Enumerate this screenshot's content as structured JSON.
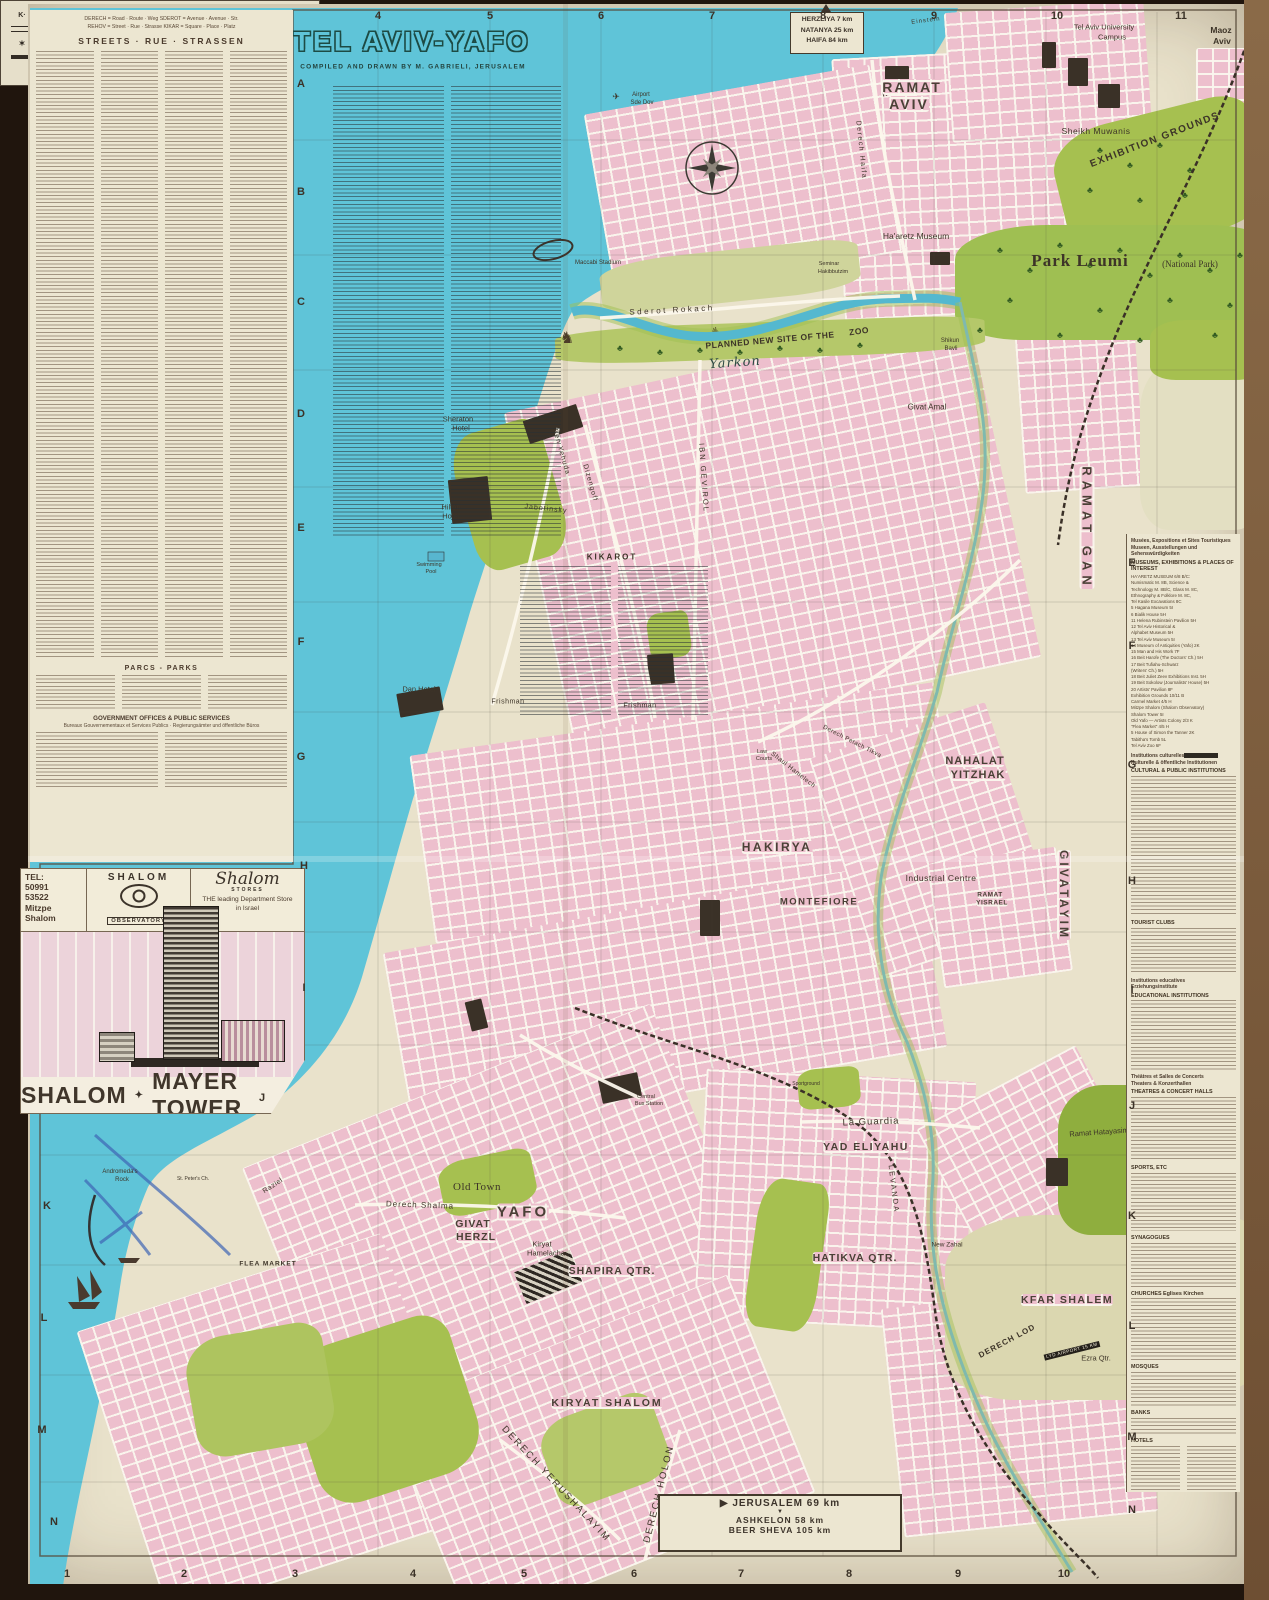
{
  "colors": {
    "sea": "#5fc4d8",
    "built_up": "#edbfcd",
    "park_green": "#a6c050",
    "paper": "#e9e2cb",
    "ink": "#3d3428"
  },
  "title": {
    "main": "TEL AVIV-YAFO",
    "credit": "COMPILED AND DRAWN BY M. GABRIELI, JERUSALEM"
  },
  "signs": {
    "north": {
      "arrow": "▲",
      "lines": [
        "HERZLIYA 7 km",
        "NATANYA 25 km",
        "HAIFA 84 km"
      ]
    },
    "south": {
      "arrow_right": "▶",
      "arrow_down": "▼",
      "lines": [
        "JERUSALEM 69 km",
        "ASHKELON 58 km",
        "BEER SHEVA 105 km"
      ]
    }
  },
  "index_panel": {
    "key_line1": "DERECH = Road · Route · Weg        SDEROT = Avenue · Avenue · Str.",
    "key_line2": "REHOV = Street · Rue · Strasse        KIKAR = Square · Place · Platz",
    "streets_header": "STREETS  ·  RUE  ·  STRASSEN",
    "parks_header": "PARCS  -  PARKS",
    "gov_header": "GOVERNMENT OFFICES & PUBLIC SERVICES",
    "gov_sub": "Bureaux Gouvernementaux et Services Publics  ·  Regierungsämter und öffentliche Büros",
    "kikarot_header": "KIKAROT"
  },
  "shalom_inset": {
    "tel_lines": [
      "TEL:",
      "50991",
      "53522",
      "Mitzpe",
      "Shalom"
    ],
    "brand": "SHALOM",
    "observatory": "OBSERVATORY",
    "stores_script": "Shalom",
    "stores_word": "STORES",
    "slogan_line1": "THE leading Department Store",
    "slogan_line2": "in Israel",
    "banner_left": "SHALOM",
    "banner_right": "MAYER TOWER"
  },
  "legend": {
    "left": [
      {
        "sym": "kikar",
        "label": "KIKAR 'Sq.' SQUARE"
      },
      {
        "sym": "road2",
        "label": "MAIN INTERURBAN ROAD"
      },
      {
        "sym": "syn",
        "label": "SYNAGOGUE"
      },
      {
        "sym": "road1",
        "label": "MAIN THROUGH ROAD"
      }
    ],
    "right": [
      {
        "sym": "rail",
        "label": "RAILWAY"
      },
      {
        "sym": "park",
        "label": "PARK"
      },
      {
        "sym": "cem",
        "label": "CEMETERY"
      },
      {
        "sym": "dot",
        "label": "HOTEL"
      }
    ],
    "credit": "© MAP BY M. GABRIELI, JERUSALEM"
  },
  "grid": {
    "top": [
      {
        "t": "4",
        "x": 378
      },
      {
        "t": "5",
        "x": 490
      },
      {
        "t": "6",
        "x": 601
      },
      {
        "t": "7",
        "x": 712
      },
      {
        "t": "8",
        "x": 823
      },
      {
        "t": "9",
        "x": 934
      },
      {
        "t": "10",
        "x": 1057
      },
      {
        "t": "11",
        "x": 1181
      }
    ],
    "bottom": [
      {
        "t": "1",
        "x": 67
      },
      {
        "t": "2",
        "x": 184
      },
      {
        "t": "3",
        "x": 295
      },
      {
        "t": "4",
        "x": 413
      },
      {
        "t": "5",
        "x": 524
      },
      {
        "t": "6",
        "x": 634
      },
      {
        "t": "7",
        "x": 741
      },
      {
        "t": "8",
        "x": 849
      },
      {
        "t": "9",
        "x": 958
      },
      {
        "t": "10",
        "x": 1064
      }
    ],
    "left": [
      {
        "t": "A",
        "x": 301,
        "y": 84
      },
      {
        "t": "B",
        "x": 301,
        "y": 192
      },
      {
        "t": "C",
        "x": 301,
        "y": 302
      },
      {
        "t": "D",
        "x": 301,
        "y": 414
      },
      {
        "t": "E",
        "x": 301,
        "y": 528
      },
      {
        "t": "F",
        "x": 301,
        "y": 642
      },
      {
        "t": "G",
        "x": 301,
        "y": 757
      },
      {
        "t": "H",
        "x": 304,
        "y": 866
      },
      {
        "t": "I",
        "x": 304,
        "y": 988
      },
      {
        "t": "J",
        "x": 262,
        "y": 1098
      },
      {
        "t": "K",
        "x": 47,
        "y": 1206
      },
      {
        "t": "L",
        "x": 44,
        "y": 1318
      },
      {
        "t": "M",
        "x": 42,
        "y": 1430
      },
      {
        "t": "N",
        "x": 54,
        "y": 1522
      }
    ],
    "right": [
      {
        "t": "E",
        "x": 1132,
        "y": 563
      },
      {
        "t": "F",
        "x": 1132,
        "y": 646
      },
      {
        "t": "G",
        "x": 1132,
        "y": 765
      },
      {
        "t": "H",
        "x": 1132,
        "y": 881
      },
      {
        "t": "I",
        "x": 1132,
        "y": 990
      },
      {
        "t": "J",
        "x": 1132,
        "y": 1106
      },
      {
        "t": "K",
        "x": 1132,
        "y": 1216
      },
      {
        "t": "L",
        "x": 1132,
        "y": 1326
      },
      {
        "t": "M",
        "x": 1132,
        "y": 1437
      },
      {
        "t": "N",
        "x": 1132,
        "y": 1510
      }
    ]
  },
  "sidebar": {
    "sections": [
      {
        "fr": "Musées, Expositions et Sites Touristiques",
        "de": "Museen, Ausstellungen und Sehenswürdigkeiten",
        "en": "MUSEUMS, EXHIBITIONS & PLACES OF INTEREST",
        "entries": [
          "HA'ARETZ MUSEUM 6/8 B/C:",
          "Numismatic M. 8B, Science &",
          "Technology M. 8B/C, Glass M. 8C,",
          "Ethnography & Folklore M. 8C,",
          "Tel Kasile Excavations 8C",
          "5 Hagana Museum 5I",
          "6 Bialik House 5H",
          "11 Helena Rubinstein Pavilion 5H",
          "12 Tel Aviv Historical &",
          "    Alphabet Museum 5H",
          "13 Tel Aviv Museum 5I",
          "14 Museum of Antiquities (Yafo) 2K",
          "15 Man and His Work 7F",
          "16 Beit Harofe (The Doctors' Ch.) 5H",
          "17 Beit Tufiahu-Schwarz",
          "    (Writers' Ch.) 5H",
          "18 Beit Juliet Zeev Exhibitions Inst. 5H",
          "19 Beit Sokolow (Journalists' House) 5H",
          "20 Artists' Pavilion 8F",
          "Exhibition Grounds 10/11 B",
          "Carmel Market 4/5 H",
          "Mitzpe Shalom (Shalom Observatory)",
          "Shalom Tower 5I",
          "Old Yafo — Artists Colony 2/3 K",
          "\"Flea Market\" 4/5 H",
          "5 House of Simon the Tanner 2K",
          "Tabitha's Tomb 5L",
          "Tel Aviv Zoo 6F"
        ],
        "fuzz": 0
      },
      {
        "fr": "Institutions culturelles",
        "de": "Kulturelle & öffentliche Institutionen",
        "en": "CULTURAL & PUBLIC INSTITUTIONS",
        "fuzz": 140,
        "hl": true
      },
      {
        "en": "TOURIST CLUBS",
        "fuzz": 46
      },
      {
        "fr": "Institutions educatives",
        "de": "Erziehungsinstitute",
        "en": "EDUCATIONAL INSTITUTIONS",
        "fuzz": 70
      },
      {
        "fr": "Théâtres et Salles de Concerts",
        "de": "Theaters & Konzerthallen",
        "en": "THEATRES & CONCERT HALLS",
        "fuzz": 64
      },
      {
        "en": "SPORTS, ETC",
        "fuzz": 58
      },
      {
        "en": "SYNAGOGUES",
        "fuzz": 44
      },
      {
        "en": "CHURCHES  Eglises  Kirchen",
        "fuzz": 62
      },
      {
        "en": "MOSQUES",
        "fuzz": 34
      },
      {
        "en": "BANKS",
        "fuzz": 16
      },
      {
        "en": "HOTELS",
        "fuzz": 70,
        "cols": 2
      }
    ]
  },
  "map_labels": [
    {
      "t": "TEL AVIV-YAFO",
      "x": 412,
      "y": 42,
      "fs": 27,
      "ls": 3,
      "cls": "title"
    },
    {
      "t": "COMPILED AND DRAWN BY M. GABRIELI, JERUSALEM",
      "x": 413,
      "y": 67,
      "fs": 6.5,
      "ls": 1.2,
      "cls": "credit"
    },
    {
      "t": "✈",
      "x": 616,
      "y": 97,
      "fs": 9,
      "cls": "dark"
    },
    {
      "t": "Airport",
      "x": 641,
      "y": 95,
      "fs": 6,
      "cls": "dark"
    },
    {
      "t": "Sde Dov",
      "x": 642,
      "y": 103,
      "fs": 6,
      "cls": "dark"
    },
    {
      "t": "READING",
      "x": 904,
      "y": 90,
      "fs": 6.5,
      "rot": -14,
      "ls": 2,
      "cls": "darkb"
    },
    {
      "t": "Tel Aviv University",
      "x": 1104,
      "y": 27,
      "fs": 7.5,
      "cls": "dark"
    },
    {
      "t": "Campus",
      "x": 1112,
      "y": 37,
      "fs": 7.5,
      "cls": "dark"
    },
    {
      "t": "Maoz",
      "x": 1221,
      "y": 30,
      "fs": 8.5,
      "cls": "darkb"
    },
    {
      "t": "Aviv",
      "x": 1222,
      "y": 41,
      "fs": 8.5,
      "cls": "darkb"
    },
    {
      "t": "Sheikh Muwanis",
      "x": 1096,
      "y": 131,
      "fs": 8.5,
      "ls": 0.5,
      "cls": "dark"
    },
    {
      "t": "RAMAT",
      "x": 912,
      "y": 87,
      "fs": 14,
      "ls": 2,
      "cls": "district"
    },
    {
      "t": "AVIV",
      "x": 909,
      "y": 104,
      "fs": 14,
      "ls": 2,
      "cls": "district"
    },
    {
      "t": "EXHIBITION GROUNDS",
      "x": 1155,
      "y": 140,
      "fs": 10,
      "rot": -21,
      "ls": 1.5,
      "cls": "darkb"
    },
    {
      "t": "Ha'aretz Museum",
      "x": 916,
      "y": 236,
      "fs": 8.5,
      "cls": "dark"
    },
    {
      "t": "Seminar",
      "x": 829,
      "y": 264,
      "fs": 5.5,
      "cls": "dark"
    },
    {
      "t": "Hakibbutzim",
      "x": 833,
      "y": 272,
      "fs": 5.5,
      "cls": "dark"
    },
    {
      "t": "Maccabi Stadium",
      "x": 598,
      "y": 263,
      "fs": 6,
      "cls": "dark"
    },
    {
      "t": "Park Leumi",
      "x": 1080,
      "y": 261,
      "fs": 17,
      "ls": 1,
      "cls": "serifb"
    },
    {
      "t": "(National Park)",
      "x": 1190,
      "y": 264,
      "fs": 9,
      "cls": "serif"
    },
    {
      "t": "Sderot Rokach",
      "x": 672,
      "y": 310,
      "fs": 8,
      "rot": -3,
      "ls": 2.5,
      "cls": "dark"
    },
    {
      "t": "PLANNED NEW SITE OF THE",
      "x": 770,
      "y": 340,
      "fs": 8.5,
      "rot": -5,
      "ls": 0.5,
      "cls": "darkb"
    },
    {
      "t": "ZOO",
      "x": 859,
      "y": 331,
      "fs": 8.5,
      "rot": -8,
      "ls": 0.5,
      "cls": "darkb"
    },
    {
      "t": "Yarkon",
      "x": 735,
      "y": 363,
      "fs": 13,
      "rot": -4,
      "ls": 1,
      "cls": "script"
    },
    {
      "t": "Shikun",
      "x": 950,
      "y": 341,
      "fs": 6,
      "cls": "dark"
    },
    {
      "t": "Bavli",
      "x": 951,
      "y": 349,
      "fs": 6,
      "cls": "dark"
    },
    {
      "t": "Givat Amal",
      "x": 927,
      "y": 407,
      "fs": 8,
      "cls": "dark"
    },
    {
      "t": "Mediterranean",
      "x": 152,
      "y": 642,
      "fs": 31,
      "rot": -63,
      "ls": 5,
      "cls": "script"
    },
    {
      "t": "Sea",
      "x": 225,
      "y": 462,
      "fs": 31,
      "rot": -55,
      "ls": 5,
      "cls": "script"
    },
    {
      "t": "Sheraton",
      "x": 458,
      "y": 419,
      "fs": 7.5,
      "cls": "dark"
    },
    {
      "t": "Hotel",
      "x": 461,
      "y": 428,
      "fs": 7.5,
      "cls": "dark"
    },
    {
      "t": "Hilton",
      "x": 451,
      "y": 507,
      "fs": 7.5,
      "cls": "dark"
    },
    {
      "t": "Hotel",
      "x": 451,
      "y": 516,
      "fs": 7.5,
      "cls": "dark"
    },
    {
      "t": "Swimming",
      "x": 429,
      "y": 565,
      "fs": 5.5,
      "cls": "dark"
    },
    {
      "t": "Pool",
      "x": 431,
      "y": 572,
      "fs": 5.5,
      "cls": "dark"
    },
    {
      "t": "Dan Hotel",
      "x": 419,
      "y": 689,
      "fs": 7.5,
      "cls": "dark"
    },
    {
      "t": "Ben Yehuda",
      "x": 561,
      "y": 452,
      "fs": 7,
      "rot": 74,
      "ls": 1,
      "cls": "dark"
    },
    {
      "t": "Dizengoff",
      "x": 590,
      "y": 483,
      "fs": 7,
      "rot": 74,
      "ls": 1,
      "cls": "dark"
    },
    {
      "t": "Jabotinsky",
      "x": 546,
      "y": 509,
      "fs": 7,
      "rot": 6,
      "ls": 1,
      "cls": "dark"
    },
    {
      "t": "IBN GEVIROL",
      "x": 704,
      "y": 478,
      "fs": 7.5,
      "rot": 86,
      "ls": 2,
      "cls": "dark"
    },
    {
      "t": "Frishman",
      "x": 508,
      "y": 702,
      "fs": 7,
      "ls": 0.5,
      "cls": "dark"
    },
    {
      "t": "Frishman",
      "x": 640,
      "y": 706,
      "fs": 7,
      "ls": 0.5,
      "cls": "dark"
    },
    {
      "t": "RAMAT GAN",
      "x": 1087,
      "y": 528,
      "fs": 13,
      "rot": 90,
      "ls": 5,
      "cls": "district"
    },
    {
      "t": "Derech Haifa",
      "x": 861,
      "y": 150,
      "fs": 7,
      "rot": 84,
      "ls": 1.5,
      "cls": "dark"
    },
    {
      "t": "Einstein",
      "x": 926,
      "y": 21,
      "fs": 6,
      "rot": -7,
      "ls": 1,
      "cls": "dark"
    },
    {
      "t": "NAHALAT",
      "x": 975,
      "y": 761,
      "fs": 11,
      "ls": 1,
      "cls": "district"
    },
    {
      "t": "YITZHAK",
      "x": 978,
      "y": 775,
      "fs": 11,
      "ls": 1,
      "cls": "district"
    },
    {
      "t": "Law",
      "x": 762,
      "y": 752,
      "fs": 5.5,
      "cls": "dark"
    },
    {
      "t": "Courts",
      "x": 764,
      "y": 759,
      "fs": 5.5,
      "cls": "dark"
    },
    {
      "t": "Shaul Hamelech",
      "x": 793,
      "y": 770,
      "fs": 6.5,
      "rot": 38,
      "ls": 0.5,
      "cls": "dark"
    },
    {
      "t": "Derech Petach Tikva",
      "x": 852,
      "y": 742,
      "fs": 6,
      "rot": 27,
      "ls": 0.5,
      "cls": "dark"
    },
    {
      "t": "HAKIRYA",
      "x": 777,
      "y": 847,
      "fs": 12,
      "ls": 2.5,
      "cls": "district"
    },
    {
      "t": "Industrial Centre",
      "x": 941,
      "y": 878,
      "fs": 8.5,
      "ls": 0.5,
      "cls": "dark"
    },
    {
      "t": "MONTEFIORE",
      "x": 819,
      "y": 902,
      "fs": 9.5,
      "ls": 1.5,
      "cls": "district"
    },
    {
      "t": "RAMAT",
      "x": 990,
      "y": 895,
      "fs": 6.5,
      "ls": 0.5,
      "cls": "district"
    },
    {
      "t": "YISRAEL",
      "x": 992,
      "y": 903,
      "fs": 6.5,
      "ls": 0.5,
      "cls": "district"
    },
    {
      "t": "GIVATAYIM",
      "x": 1064,
      "y": 895,
      "fs": 12,
      "rot": 90,
      "ls": 3,
      "cls": "district"
    },
    {
      "t": "La Guardia",
      "x": 871,
      "y": 1122,
      "fs": 9.5,
      "rot": -2,
      "ls": 1,
      "cls": "dark"
    },
    {
      "t": "YAD ELIYAHU",
      "x": 866,
      "y": 1147,
      "fs": 10.5,
      "ls": 1.5,
      "cls": "district"
    },
    {
      "t": "Sportground",
      "x": 806,
      "y": 1084,
      "fs": 5,
      "cls": "dark"
    },
    {
      "t": "HATIKVA QTR.",
      "x": 855,
      "y": 1258,
      "fs": 10.5,
      "ls": 1,
      "cls": "district"
    },
    {
      "t": "New Zahal",
      "x": 947,
      "y": 1245,
      "fs": 6.5,
      "cls": "dark"
    },
    {
      "t": "Ramat Hatayasim",
      "x": 1099,
      "y": 1132,
      "fs": 7.5,
      "rot": -4,
      "cls": "dark"
    },
    {
      "t": "KFAR SHALEM",
      "x": 1067,
      "y": 1300,
      "fs": 10.5,
      "ls": 1.5,
      "cls": "district"
    },
    {
      "t": "GIVAT",
      "x": 473,
      "y": 1224,
      "fs": 10.5,
      "ls": 1,
      "cls": "district"
    },
    {
      "t": "HERZL",
      "x": 476,
      "y": 1237,
      "fs": 10.5,
      "ls": 1,
      "cls": "district"
    },
    {
      "t": "Kiryat",
      "x": 542,
      "y": 1244,
      "fs": 7.5,
      "cls": "dark"
    },
    {
      "t": "Hamelacha",
      "x": 546,
      "y": 1253,
      "fs": 7.5,
      "cls": "dark"
    },
    {
      "t": "SHAPIRA QTR.",
      "x": 612,
      "y": 1271,
      "fs": 10.5,
      "ls": 1,
      "cls": "district"
    },
    {
      "t": "Central",
      "x": 646,
      "y": 1097,
      "fs": 5.5,
      "cls": "dark"
    },
    {
      "t": "Bus Station",
      "x": 649,
      "y": 1104,
      "fs": 5.5,
      "cls": "dark"
    },
    {
      "t": "LEVANDA",
      "x": 894,
      "y": 1189,
      "fs": 7.5,
      "rot": 83,
      "ls": 2,
      "cls": "dark"
    },
    {
      "t": "Derech Shalma",
      "x": 420,
      "y": 1205,
      "fs": 8,
      "rot": 2,
      "ls": 1,
      "cls": "dark"
    },
    {
      "t": "Old Town",
      "x": 477,
      "y": 1187,
      "fs": 11,
      "ls": 0.5,
      "cls": "serif"
    },
    {
      "t": "YAFO",
      "x": 523,
      "y": 1212,
      "fs": 15,
      "ls": 3,
      "cls": "district"
    },
    {
      "t": "FLEA MARKET",
      "x": 268,
      "y": 1264,
      "fs": 6.5,
      "ls": 1,
      "cls": "darkb"
    },
    {
      "t": "Andromeda's",
      "x": 120,
      "y": 1172,
      "fs": 6,
      "cls": "dark"
    },
    {
      "t": "Rock",
      "x": 122,
      "y": 1180,
      "fs": 6,
      "cls": "dark"
    },
    {
      "t": "St. Peter's Ch.",
      "x": 193,
      "y": 1179,
      "fs": 5,
      "cls": "dark"
    },
    {
      "t": "Raziel",
      "x": 273,
      "y": 1186,
      "fs": 7,
      "rot": -33,
      "ls": 0.5,
      "cls": "dark"
    },
    {
      "t": "KIRYAT SHALOM",
      "x": 607,
      "y": 1403,
      "fs": 10.5,
      "ls": 2,
      "cls": "district"
    },
    {
      "t": "DERECH YERUSHALAYIM",
      "x": 556,
      "y": 1484,
      "fs": 9.5,
      "rot": 47,
      "ls": 2,
      "cls": "dark"
    },
    {
      "t": "DERECH HOLON",
      "x": 659,
      "y": 1494,
      "fs": 9.5,
      "rot": -76,
      "ls": 2,
      "cls": "dark"
    },
    {
      "t": "DERECH LOD",
      "x": 1007,
      "y": 1341,
      "fs": 8,
      "rot": -28,
      "ls": 1,
      "cls": "darkb"
    },
    {
      "t": "LYD AIRPORT 15 KM",
      "x": 1072,
      "y": 1351,
      "fs": 4.6,
      "rot": -14,
      "ls": 0.5,
      "cls": "chip"
    },
    {
      "t": "Ezra Qtr.",
      "x": 1096,
      "y": 1358,
      "fs": 7.5,
      "cls": "dark"
    },
    {
      "t": "KIKAROT",
      "x": 612,
      "y": 557,
      "fs": 8,
      "ls": 2,
      "cls": "darkb"
    }
  ]
}
